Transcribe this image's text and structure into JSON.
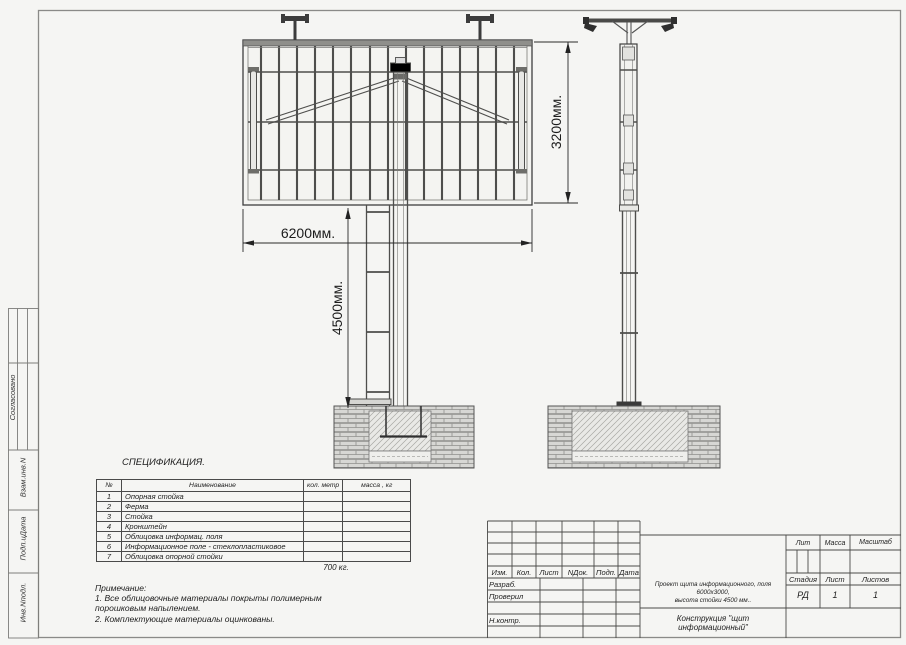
{
  "margin": {
    "labels": [
      "Согласовано",
      "Взам.инв.N",
      "Подп.иДата",
      "Инв.Nподл."
    ]
  },
  "drawing": {
    "dim_width": "6200мм.",
    "dim_stand_height": "4500мм.",
    "dim_panel_height": "3200мм."
  },
  "spec": {
    "title": "СПЕЦИФИКАЦИЯ.",
    "col_num": "№",
    "col_name": "Наименование",
    "col_qty": "кол. метр",
    "col_mass": "масса , кг",
    "rows": [
      {
        "num": "1",
        "name": "Опорная стойка"
      },
      {
        "num": "2",
        "name": "Ферма"
      },
      {
        "num": "3",
        "name": "Стойка"
      },
      {
        "num": "4",
        "name": "Кронштейн"
      },
      {
        "num": "5",
        "name": "Облицовка информац. поля"
      },
      {
        "num": "6",
        "name": "Информационное поле - стеклопластиковое"
      },
      {
        "num": "7",
        "name": "Облицовка опорной стойки"
      }
    ],
    "total": "700 кг."
  },
  "notes": {
    "title": "Примечание:",
    "line1": "1. Все облицовочные материалы покрыты полимерным",
    "line2": "порошковым напылением.",
    "line3": "2. Комплектующие материалы оцинкованы."
  },
  "titleblock": {
    "rev_cols": [
      "Изм.",
      "Кол.",
      "Лист",
      "NДок.",
      "Подп.",
      "Дата"
    ],
    "roles": [
      "Разраб.",
      "Проверил",
      "Н.контр."
    ],
    "description_line1": "Проект щита информационного, поля 6000х3000,",
    "description_line2": "высота стойки 4500 мм..",
    "construction": "Конструкция \"щит информационный\"",
    "lit": "Лит",
    "mass": "Масса",
    "scale": "Масштаб",
    "stage": "Стадия",
    "sheet": "Лист",
    "sheets": "Листов",
    "stage_value": "РД",
    "sheet_value": "1",
    "sheets_value": "1"
  }
}
